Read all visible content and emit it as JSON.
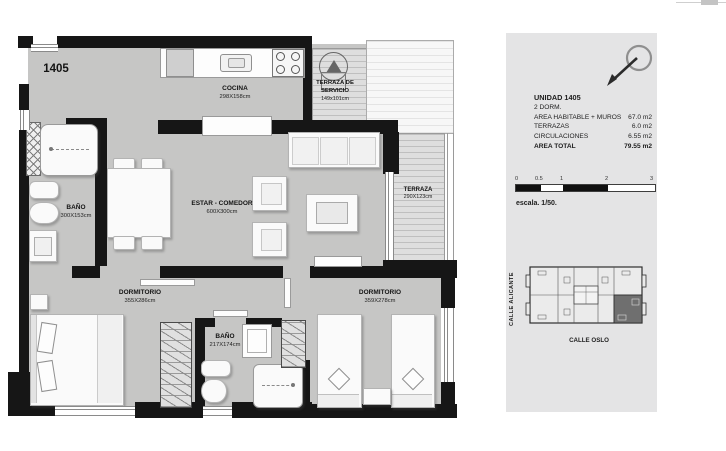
{
  "floor_plan": {
    "unit_label": "1405",
    "rooms": {
      "cocina": {
        "name": "COCINA",
        "dims": "298X158cm"
      },
      "terraza_servicio": {
        "name_line1": "TERRAZA DE",
        "name_line2": "SERVICIO",
        "dims": "149x101cm"
      },
      "estar_comedor": {
        "name": "ESTAR - COMEDOR",
        "dims": "600X300cm"
      },
      "terraza": {
        "name": "TERRAZA",
        "dims": "290X123cm"
      },
      "bano_principal": {
        "name": "BAÑO",
        "dims": "300X153cm"
      },
      "bano_secundario": {
        "name": "BAÑO",
        "dims": "217X174cm"
      },
      "dormitorio_principal": {
        "name": "DORMITORIO",
        "dims": "355X286cm"
      },
      "dormitorio_secundario": {
        "name": "DORMITORIO",
        "dims": "359X278cm"
      }
    }
  },
  "info_panel": {
    "unit_title": "UNIDAD 1405",
    "subtitle": "2 DORM.",
    "rows": [
      {
        "label": "AREA HABITABLE + MUROS",
        "value": "67.0 m2"
      },
      {
        "label": "TERRAZAS",
        "value": "6.0 m2"
      },
      {
        "label": "CIRCULACIONES",
        "value": "6.55 m2"
      }
    ],
    "total": {
      "label": "AREA TOTAL",
      "value": "79.55 m2"
    },
    "scale_bar": {
      "ticks": [
        "0",
        "0.5",
        "1",
        "2",
        "3"
      ]
    },
    "scale_label": "escala. 1/50.",
    "key_plan": {
      "street_left": "CALLE ALICANTE",
      "street_bottom": "CALLE OSLO"
    }
  },
  "colors": {
    "floor": "#c6c6c5",
    "wall": "#161616",
    "panel_bg": "#e4e4e5",
    "keyplan_highlight": "#6f6f6f"
  }
}
